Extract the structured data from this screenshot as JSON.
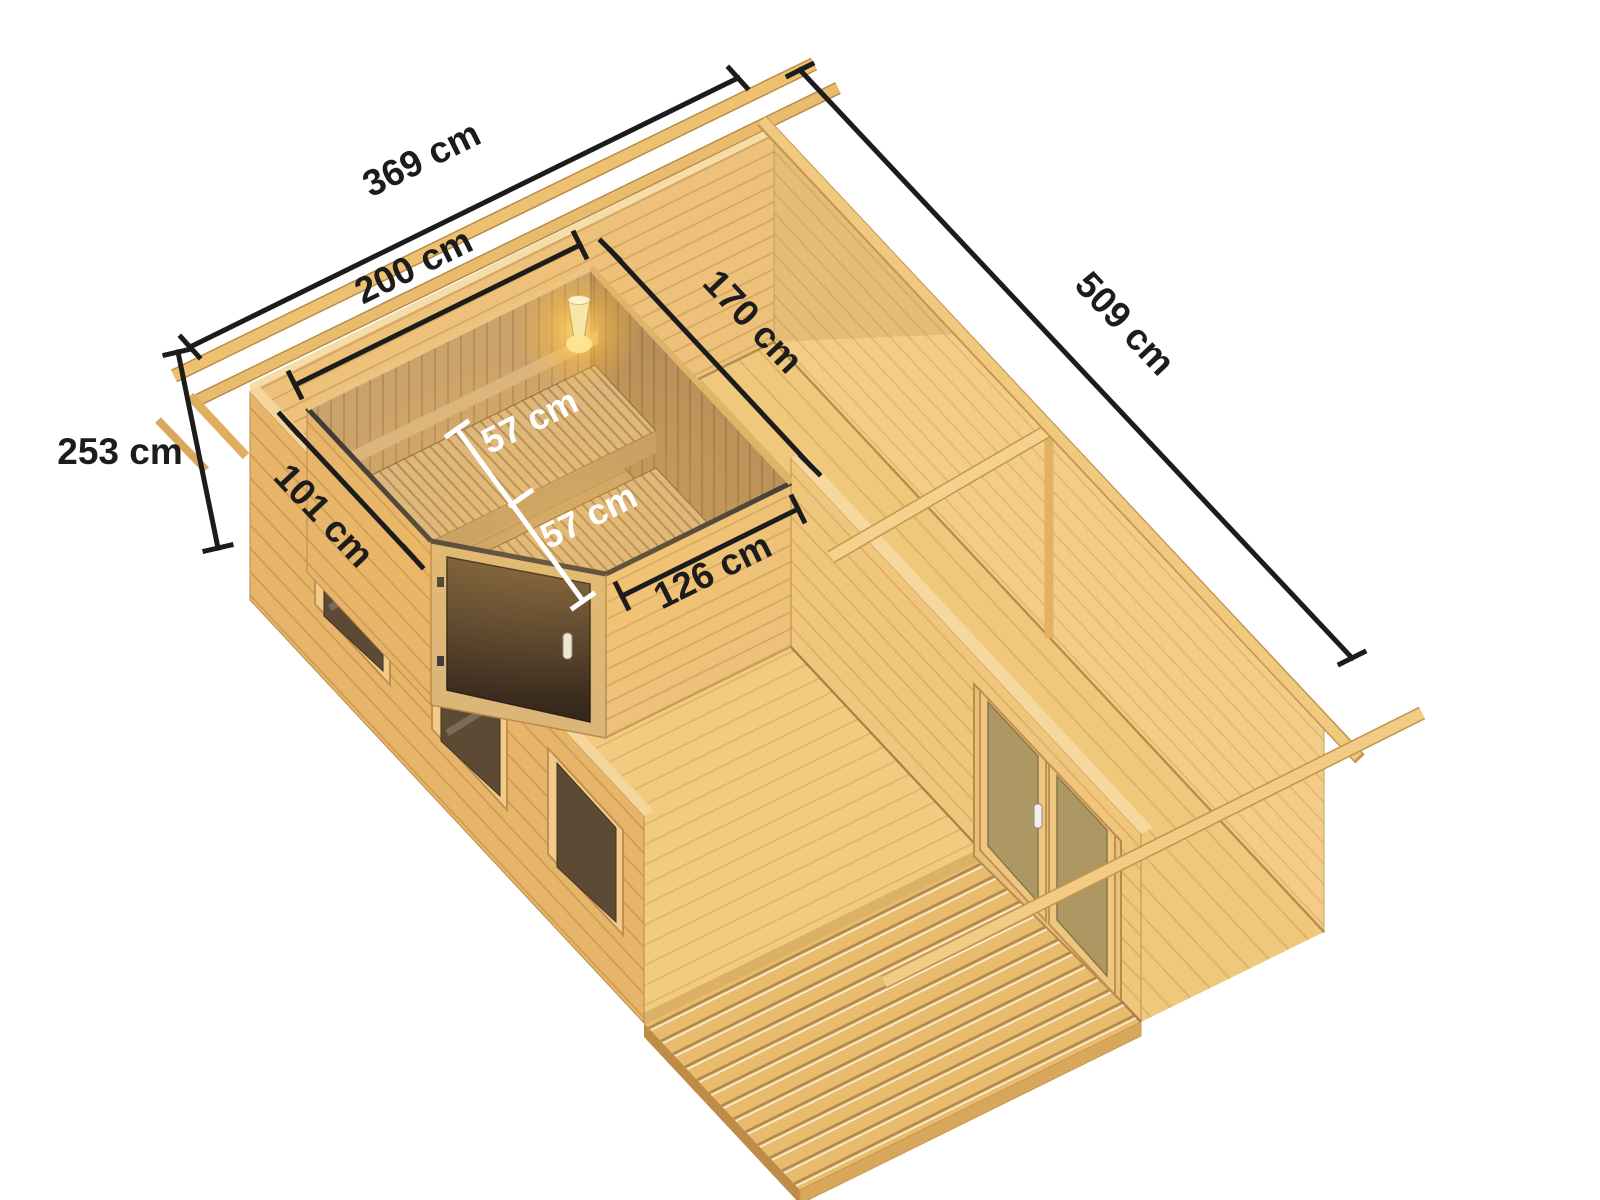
{
  "image": {
    "type": "product-render",
    "subject": "Wooden log sauna cabin, top cutaway view with dimension annotations",
    "background": "#ffffff"
  },
  "colors": {
    "background": "#ffffff",
    "wood_light": "#f2ca7e",
    "wood_medium": "#e7b56a",
    "wood_dark": "#c09050",
    "wood_floor": "#efc87c",
    "sauna_wood": "#cba26b",
    "bench_wood": "#dab57e",
    "door_glass": "#4a3629",
    "window_glass": "#5d4a34",
    "partition_door_glass": "#a59260",
    "lamp_glow": "#ffd966",
    "dimension_line": "#1c1c1c",
    "dimension_line_alt": "#ffffff"
  },
  "dimensions": {
    "cabin_width": "369 cm",
    "cabin_depth": "509 cm",
    "wall_height": "253 cm",
    "sauna_width": "200 cm",
    "sauna_depth": "170 cm",
    "sauna_left_wall": "101 cm",
    "sauna_front_wall": "126 cm",
    "bench_upper_depth": "57 cm",
    "bench_lower_depth": "57 cm"
  }
}
